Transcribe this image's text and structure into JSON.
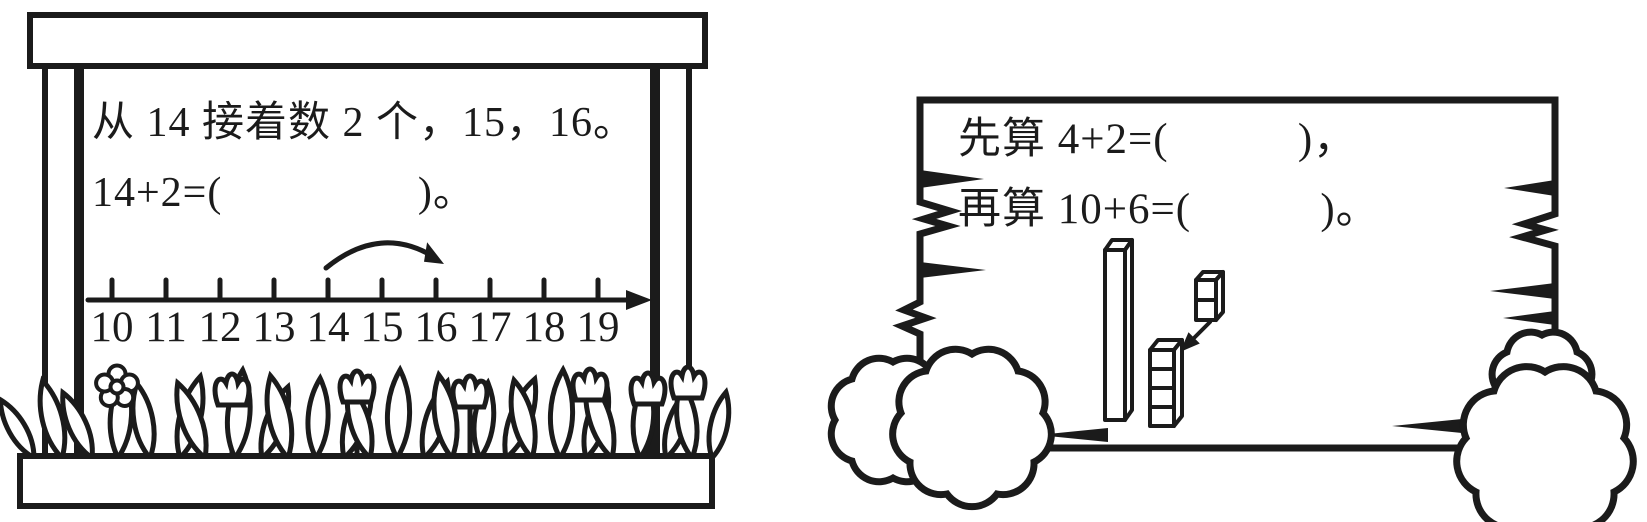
{
  "colors": {
    "ink": "#1b1b1b",
    "paper": "#ffffff"
  },
  "left_panel": {
    "line1": "从 14 接着数 2 个，15，16。",
    "line2": "14+2=(                 )。",
    "number_line": {
      "labels": [
        "10",
        "11",
        "12",
        "13",
        "14",
        "15",
        "16",
        "17",
        "18",
        "19"
      ],
      "jump_from": 14,
      "jump_to": 16
    }
  },
  "right_panel": {
    "line1": "先算 4+2=(           )，",
    "line2": "再算 10+6=(           )。",
    "blocks": {
      "tens_rods": 1,
      "unit_cubes_stack": 4,
      "unit_cubes_added": 2
    }
  }
}
